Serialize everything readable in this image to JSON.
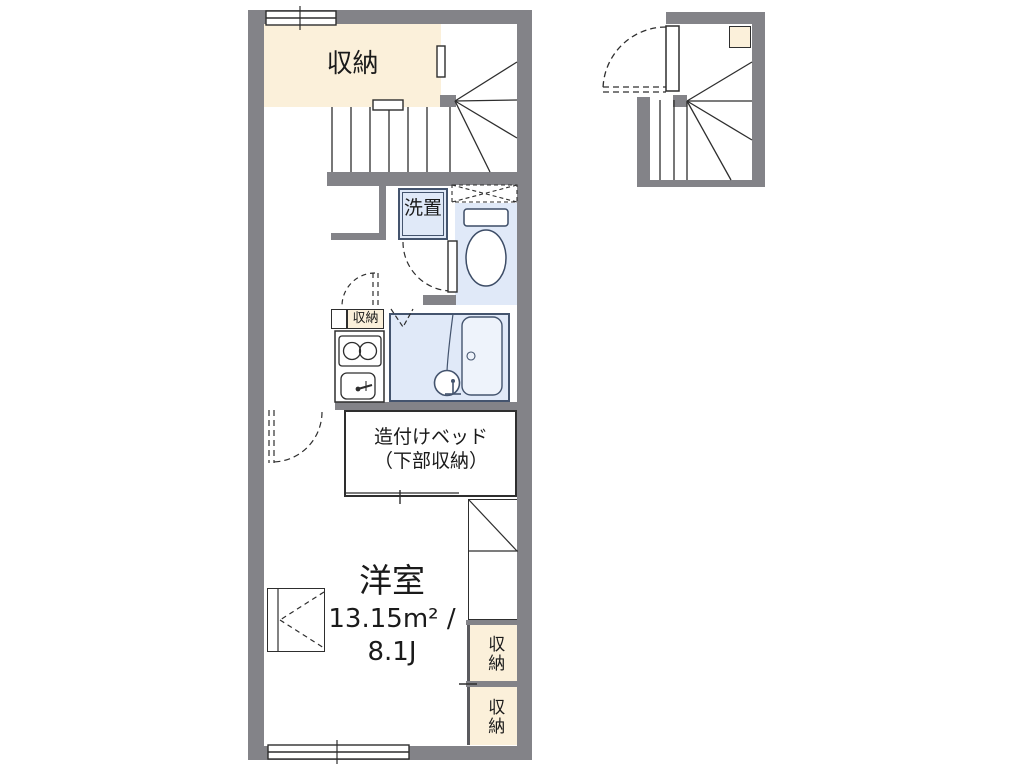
{
  "plan_type": "floor-plan",
  "colors": {
    "wall": "#838388",
    "storage_fill": "#fbf0da",
    "wet_area_fill": "#e0e9f8",
    "tub_fill": "#eef3fb",
    "line": "#2e2e2e",
    "background": "#ffffff"
  },
  "rooms": {
    "storage_top": {
      "label": "収納"
    },
    "laundry": {
      "label": "洗置"
    },
    "kitchen_storage": {
      "label": "収納"
    },
    "bed": {
      "label_line1": "造付けベッド",
      "label_line2": "（下部収納）"
    },
    "main_room": {
      "name": "洋室",
      "area_sqm": "13.15m² /",
      "area_tatami": "8.1J"
    },
    "closet_upper": {
      "label": "収納"
    },
    "closet_lower": {
      "label": "収納"
    }
  },
  "fixtures": [
    "staircase-main",
    "staircase-detached",
    "toilet",
    "upper-cabinet",
    "washing-machine-space",
    "unit-bath",
    "bathtub",
    "washbasin",
    "stove",
    "kitchen-sink",
    "built-in-bed",
    "refrigerator-space",
    "window",
    "door-swing",
    "folding-door"
  ]
}
